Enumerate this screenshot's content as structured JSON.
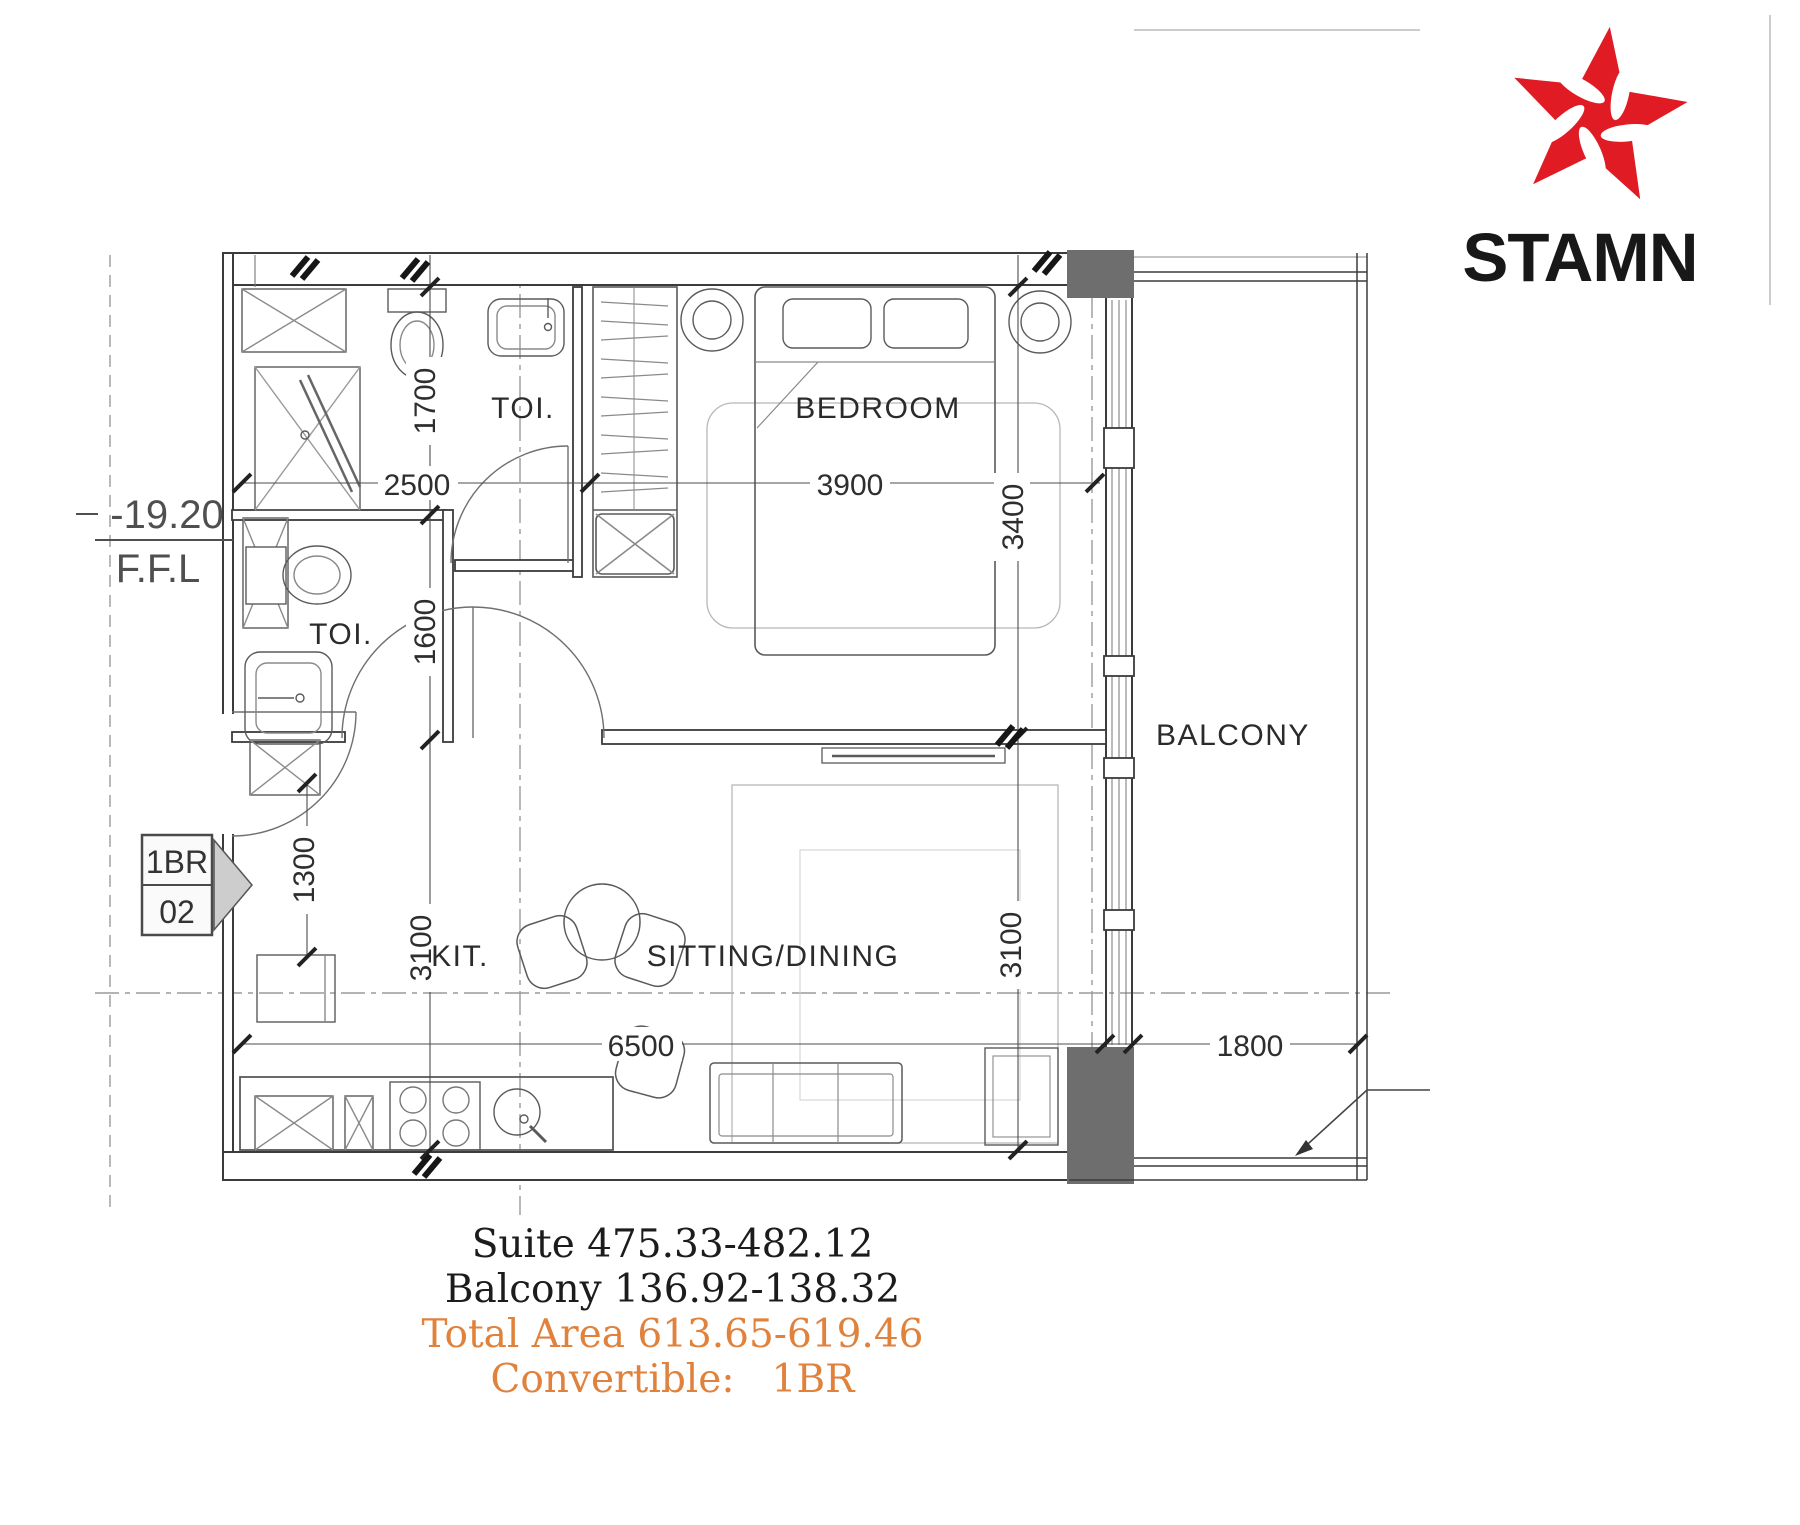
{
  "logo": {
    "brand": "STAMN"
  },
  "plan": {
    "rooms": {
      "toilet_top": "TOI.",
      "bedroom": "BEDROOM",
      "toilet_mid": "TOI.",
      "balcony": "BALCONY",
      "kitchen": "KIT.",
      "sitting_dining": "SITTING/DINING"
    },
    "dims": {
      "w_toilet": "2500",
      "w_bedroom": "3900",
      "h_toilet_top": "1700",
      "h_toilet_mid": "1600",
      "h_bedroom": "3400",
      "h_entry": "1300",
      "h_kitchen": "3100",
      "h_sitting": "3100",
      "w_unit": "6500",
      "w_balcony": "1800"
    },
    "level": {
      "value": "-19.20",
      "label": "F.F.L"
    },
    "unit_tag": {
      "line1": "1BR",
      "line2": "02"
    }
  },
  "summary": {
    "suite": "Suite 475.33-482.12",
    "balcony": "Balcony 136.92-138.32",
    "total_area": "Total Area 613.65-619.46",
    "convertible": "Convertible:   1BR"
  },
  "colors": {
    "accent_orange": "#e0813c",
    "logo_red": "#e01b24",
    "wall_gray": "#6e6e6e"
  }
}
